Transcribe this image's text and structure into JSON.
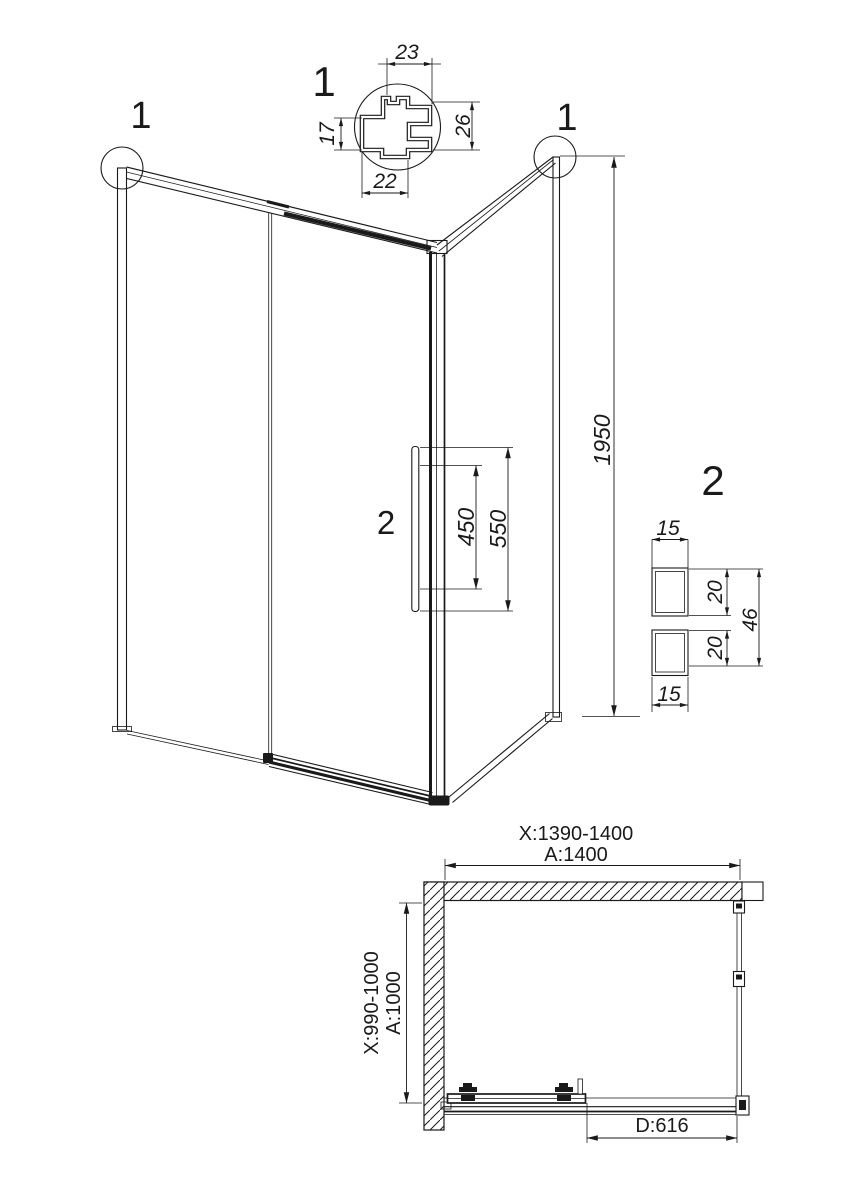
{
  "colors": {
    "line": "#1a1a1a",
    "background": "#ffffff"
  },
  "detail_1": {
    "label": "1",
    "dim_top": "23",
    "dim_left": "17",
    "dim_bottom": "22",
    "dim_right": "26"
  },
  "elevation": {
    "callout_left": "1",
    "callout_right": "1",
    "height_dim": "1950",
    "handle_label": "2",
    "handle_dim_inner": "450",
    "handle_dim_outer": "550"
  },
  "detail_2": {
    "label": "2",
    "dim_width_top": "15",
    "dim_height_top": "20",
    "dim_height_bottom": "20",
    "dim_height_total": "46",
    "dim_width_bottom": "15"
  },
  "plan": {
    "width_range": "X:1390-1400",
    "width_nominal": "A:1400",
    "depth_range": "X:990-1000",
    "depth_nominal": "A:1000",
    "door_width": "D:616"
  }
}
